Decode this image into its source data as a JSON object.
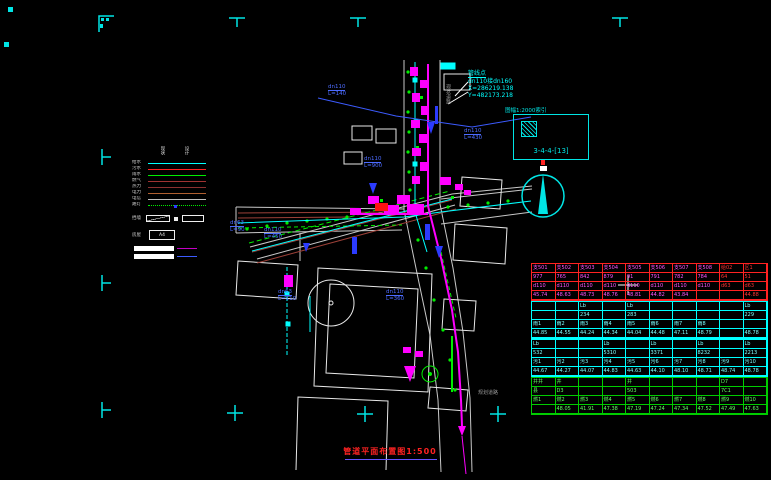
{
  "survey": {
    "title": "管线点",
    "line2": "dn110接dn160",
    "line3": "X=286219.138",
    "line4": "Y=482173.218"
  },
  "detail": {
    "caption": "图幅1:2000索引",
    "sheet": "3-4-4-[13]"
  },
  "title": {
    "text": "管道平面布置图1:500"
  },
  "legend": {
    "col1": "现状",
    "col2": "设计",
    "rows": [
      {
        "label": "给水",
        "color": "#00ffff",
        "style": "solid"
      },
      {
        "label": "污水",
        "color": "#ff2222",
        "style": "solid"
      },
      {
        "label": "雨水",
        "color": "#00ee00",
        "style": "solid"
      },
      {
        "label": "燃气",
        "color": "#a03232",
        "style": "solid"
      },
      {
        "label": "热力",
        "color": "#8b3030",
        "style": "solid"
      },
      {
        "label": "电力",
        "color": "#b06030",
        "style": "solid"
      },
      {
        "label": "电信",
        "color": "#c0c0c0",
        "style": "solid"
      },
      {
        "label": "路灯",
        "color": "#00ee00",
        "style": "dotted"
      }
    ],
    "sym_label": "挡墙",
    "a4_label": "房屋",
    "a4_text": "A4"
  },
  "map": {
    "pipe_labels": [
      {
        "l1": "dn110",
        "l2": "L=140",
        "x": 328,
        "y": 84
      },
      {
        "l1": "dn110",
        "l2": "L=430",
        "x": 464,
        "y": 128
      },
      {
        "l1": "dn110",
        "l2": "L=900",
        "x": 364,
        "y": 156
      },
      {
        "l1": "dn63",
        "l2": "L=90",
        "x": 230,
        "y": 220
      },
      {
        "l1": "dn110",
        "l2": "L=450",
        "x": 264,
        "y": 227
      },
      {
        "l1": "dn63",
        "l2": "L=110",
        "x": 278,
        "y": 289
      },
      {
        "l1": "dn110",
        "l2": "L=360",
        "x": 386,
        "y": 289
      }
    ],
    "road_labels": [
      {
        "text": "现状道路",
        "x": 445,
        "y": 84,
        "vertical": true
      },
      {
        "text": "规划道路",
        "x": 478,
        "y": 389,
        "vertical": false
      }
    ]
  },
  "table": {
    "blocks": [
      {
        "border": "#ff2222",
        "color": "#ff55ff",
        "last2red": true,
        "rows": [
          [
            "支501",
            "支502",
            "支503",
            "支504",
            "支505",
            "支506",
            "支507",
            "支508",
            "给02",
            "区1"
          ],
          [
            "977",
            "765",
            "842",
            "879",
            "91",
            "791",
            "782",
            "784",
            "64",
            "51"
          ],
          [
            "d110",
            "d110",
            "d110",
            "d110",
            "d110",
            "d110",
            "d110",
            "d110",
            "d63",
            "d63"
          ],
          [
            "45.74",
            "48.63",
            "48.73",
            "48.76",
            "48.81",
            "44.82",
            "43.84",
            "",
            "",
            "44.88"
          ]
        ]
      },
      {
        "border": "#00ffff",
        "color": "#7fffff",
        "last2red": false,
        "rows": [
          [
            "",
            "",
            "Lb",
            "",
            "Lb",
            "",
            "",
            "",
            "",
            "Lb"
          ],
          [
            "",
            "",
            "234",
            "",
            "283",
            "",
            "",
            "",
            "",
            "229"
          ],
          [
            "雨1",
            "雨2",
            "雨3",
            "雨4",
            "雨5",
            "雨6",
            "雨7",
            "雨8",
            "",
            ""
          ],
          [
            "44.85",
            "44.55",
            "44.24",
            "44.34",
            "44.04",
            "44.48",
            "47.11",
            "48.79",
            "",
            "48.78"
          ]
        ]
      },
      {
        "border": "#00ffff",
        "color": "#7fffff",
        "last2red": false,
        "rows": [
          [
            "Lb",
            "",
            "",
            "Lb",
            "",
            "Lb",
            "",
            "Lb",
            "",
            "Lb"
          ],
          [
            "532",
            "",
            "",
            "5310",
            "",
            "3371",
            "",
            "8232",
            "",
            "2213"
          ],
          [
            "污1",
            "污2",
            "污3",
            "污4",
            "污5",
            "污6",
            "污7",
            "污8",
            "污9",
            "污10"
          ],
          [
            "44.67",
            "44.27",
            "44.07",
            "44.83",
            "44.63",
            "44.10",
            "48.10",
            "48.71",
            "48.74",
            "48.78"
          ]
        ]
      },
      {
        "border": "#00cc00",
        "color": "#66ff66",
        "last2red": false,
        "rows": [
          [
            "井井",
            "井",
            "",
            "",
            "井",
            "",
            "",
            "",
            "D7",
            ""
          ],
          [
            "县",
            "D3",
            "",
            "",
            "503",
            "",
            "",
            "",
            "7C1",
            ""
          ],
          [
            "燃1",
            "燃2",
            "燃3",
            "燃4",
            "燃5",
            "燃6",
            "燃7",
            "燃8",
            "燃9",
            "燃10"
          ],
          [
            "",
            "48.05",
            "41.91",
            "47.38",
            "47.19",
            "47.24",
            "47.34",
            "47.52",
            "47.49",
            "47.63"
          ]
        ]
      }
    ]
  },
  "colors": {
    "cyan": "#00ffff",
    "magenta": "#ff00ff",
    "red": "#ff2222",
    "green": "#00ee00",
    "blue": "#2b3bff",
    "brown": "#9c4038",
    "white": "#ffffff"
  }
}
